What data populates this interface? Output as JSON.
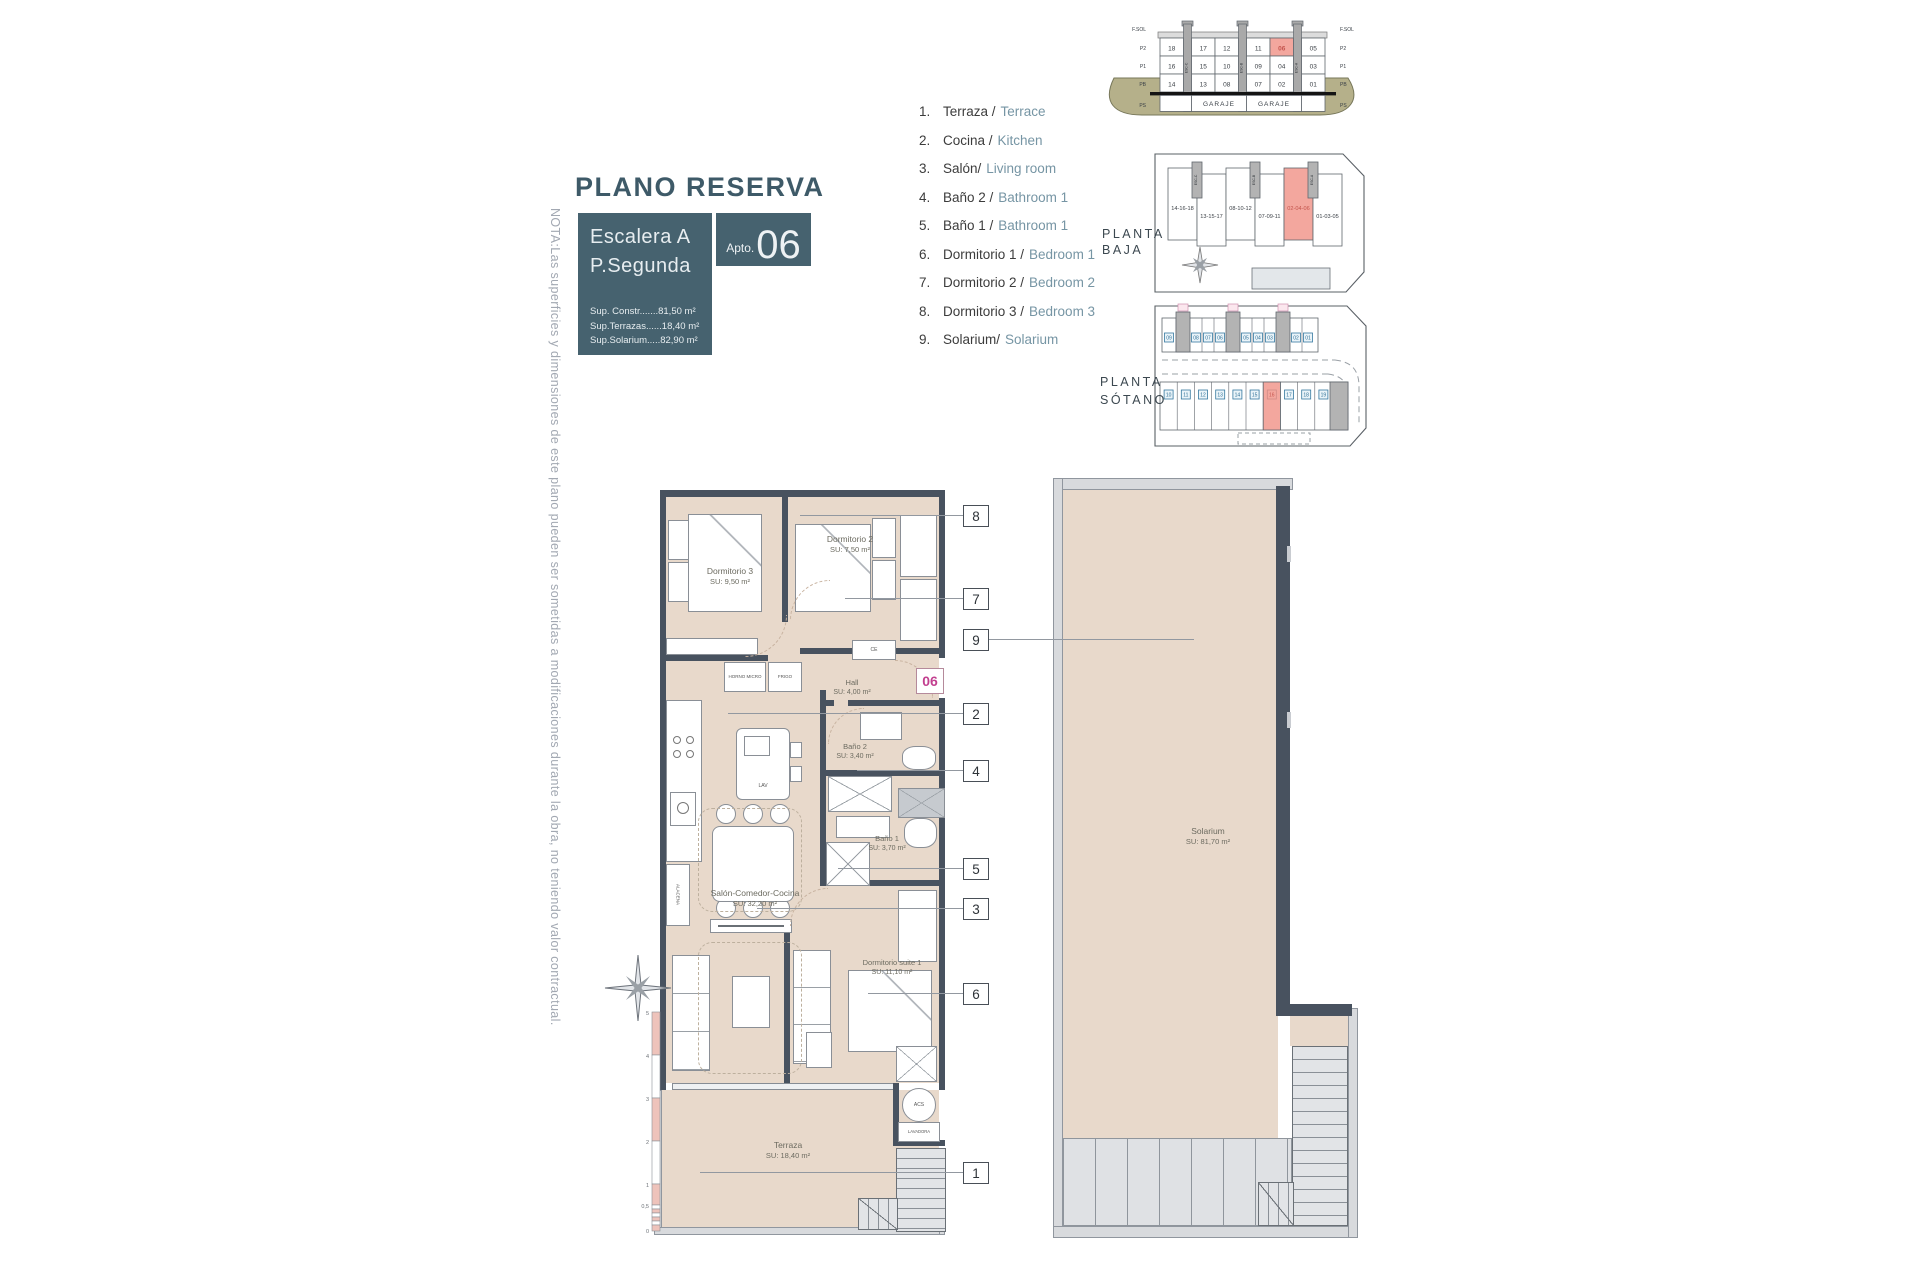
{
  "title": "PLANO RESERVA",
  "unit": {
    "escalera": "Escalera A",
    "planta": "P.Segunda",
    "apto_label": "Apto.",
    "apto_number": "06",
    "surfaces": [
      "Sup. Constr.......81,50 m²",
      "Sup.Terrazas......18,40 m²",
      "Sup.Solarium.....82,90 m²"
    ]
  },
  "note": "NOTA:Las superficies y dimensiones de este plano pueden ser sometidas a modificaciones durante la obra, no teniendo valor contractual.",
  "legend": {
    "items": [
      {
        "num": "1.",
        "es": "Terraza /",
        "en": "Terrace"
      },
      {
        "num": "2.",
        "es": "Cocina /",
        "en": "Kitchen"
      },
      {
        "num": "3.",
        "es": "Salón/",
        "en": "Living room"
      },
      {
        "num": "4.",
        "es": "Baño 2 /",
        "en": "Bathroom 1"
      },
      {
        "num": "5.",
        "es": "Baño 1 /",
        "en": "Bathroom 1"
      },
      {
        "num": "6.",
        "es": "Dormitorio 1 /",
        "en": "Bedroom 1"
      },
      {
        "num": "7.",
        "es": "Dormitorio 2 /",
        "en": "Bedroom 2"
      },
      {
        "num": "8.",
        "es": "Dormitorio 3 /",
        "en": "Bedroom 3"
      },
      {
        "num": "9.",
        "es": "Solarium/",
        "en": "Solarium"
      }
    ]
  },
  "section": {
    "levels": [
      "F.SOL",
      "P2",
      "P1",
      "PB",
      "PS"
    ],
    "garaje": "GARAJE",
    "cores": [
      "ESC-C",
      "ESC-B",
      "ESC-A"
    ],
    "columns": [
      [
        "18",
        "16",
        "14"
      ],
      [
        "17",
        "15",
        "13"
      ],
      [
        "12",
        "10",
        "08"
      ],
      [
        "11",
        "09",
        "07"
      ],
      [
        "06",
        "04",
        "02"
      ],
      [
        "05",
        "03",
        "01"
      ]
    ],
    "highlight_unit": "06"
  },
  "planta_baja": {
    "label": [
      "PLANTA",
      "BAJA"
    ],
    "units": [
      "14-16-18",
      "13-15-17",
      "08-10-12",
      "07-09-11",
      "02-04-06",
      "01-03-05"
    ],
    "highlight_unit": "02-04-06"
  },
  "planta_sotano": {
    "label": [
      "PLANTA",
      "SÓTANO"
    ],
    "top_cells": [
      "09",
      "08",
      "07",
      "06",
      "05",
      "04",
      "03",
      "02",
      "01"
    ],
    "bottom_cells": [
      "10",
      "11",
      "12",
      "13",
      "14",
      "15",
      "16",
      "17",
      "18",
      "19"
    ],
    "highlight_cell": "16"
  },
  "floorplan": {
    "badge": "06",
    "rooms": {
      "dorm3": {
        "name": "Dormitorio 3",
        "area": "SU: 9,50 m²"
      },
      "dorm2": {
        "name": "Dormitorio 2",
        "area": "SU: 7,50 m²"
      },
      "hall": {
        "name": "Hall",
        "area": "SU: 4,00 m²"
      },
      "bano2": {
        "name": "Baño 2",
        "area": "SU: 3,40 m²"
      },
      "bano1": {
        "name": "Baño 1",
        "area": "SU: 3,70 m²"
      },
      "salon": {
        "name": "Salón-Comedor-Cocina",
        "area": "SU: 32,20 m²"
      },
      "suite": {
        "name": "Dormitorio suite 1",
        "area": "SU: 11,10 m²"
      },
      "terraza": {
        "name": "Terraza",
        "area": "SU: 18,40 m²"
      }
    },
    "fixtures": {
      "horno": "HORNO MICRO",
      "frigo": "FRIGO",
      "lav": "LAV",
      "alacena": "ALACENA",
      "ce": "CE",
      "acs": "ACS",
      "lavadora": "LAVADORA"
    },
    "callouts": [
      "1",
      "2",
      "3",
      "4",
      "5",
      "6",
      "7",
      "8",
      "9"
    ]
  },
  "solarium": {
    "name": "Solarium",
    "area": "SU: 81,70 m²"
  },
  "scalebar": [
    "5",
    "4",
    "3",
    "2",
    "1",
    "0,5",
    "0"
  ],
  "colors": {
    "teal": "#46626f",
    "salmon": "#f3a79e",
    "magenta": "#c23f8f",
    "wall": "#48525f",
    "floor": "#e8d9cb",
    "ground_olive": "#b5b08a",
    "legend_en": "#7695a4"
  }
}
